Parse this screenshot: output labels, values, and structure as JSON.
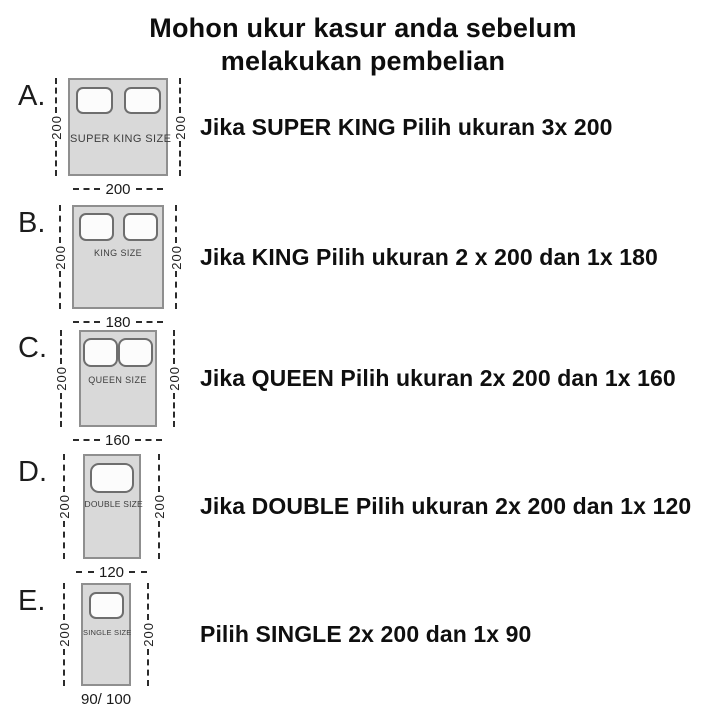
{
  "title": {
    "line1": "Mohon ukur kasur anda sebelum",
    "line2": "melakukan pembelian"
  },
  "rows": [
    {
      "letter": "A.",
      "bed_label": "SUPER KING SIZE",
      "side_label_left": "200",
      "side_label_right": "200",
      "bottom_label": "200",
      "pillows": 2,
      "text": "Jika SUPER KING Pilih ukuran 3x 200"
    },
    {
      "letter": "B.",
      "bed_label": "KING SIZE",
      "side_label_left": "200",
      "side_label_right": "200",
      "bottom_label": "180",
      "pillows": 2,
      "text": "Jika KING Pilih ukuran 2 x 200 dan 1x 180"
    },
    {
      "letter": "C.",
      "bed_label": "QUEEN SIZE",
      "side_label_left": "200",
      "side_label_right": "200",
      "bottom_label": "160",
      "pillows": 2,
      "text": "Jika QUEEN Pilih ukuran 2x 200 dan 1x 160"
    },
    {
      "letter": "D.",
      "bed_label": "DOUBLE SIZE",
      "side_label_left": "200",
      "side_label_right": "200",
      "bottom_label": "120",
      "pillows": 1,
      "text": "Jika DOUBLE Pilih ukuran 2x 200 dan 1x 120"
    },
    {
      "letter": "E.",
      "bed_label": "SINGLE SIZE",
      "side_label_left": "200",
      "side_label_right": "200",
      "bottom_label": "90/ 100",
      "pillows": 1,
      "text": "Pilih SINGLE 2x 200 dan 1x 90"
    }
  ],
  "colors": {
    "bed_fill": "#d9d9d9",
    "bed_border": "#8f8f8f",
    "line": "#2b2b2b",
    "ink": "#111111"
  }
}
